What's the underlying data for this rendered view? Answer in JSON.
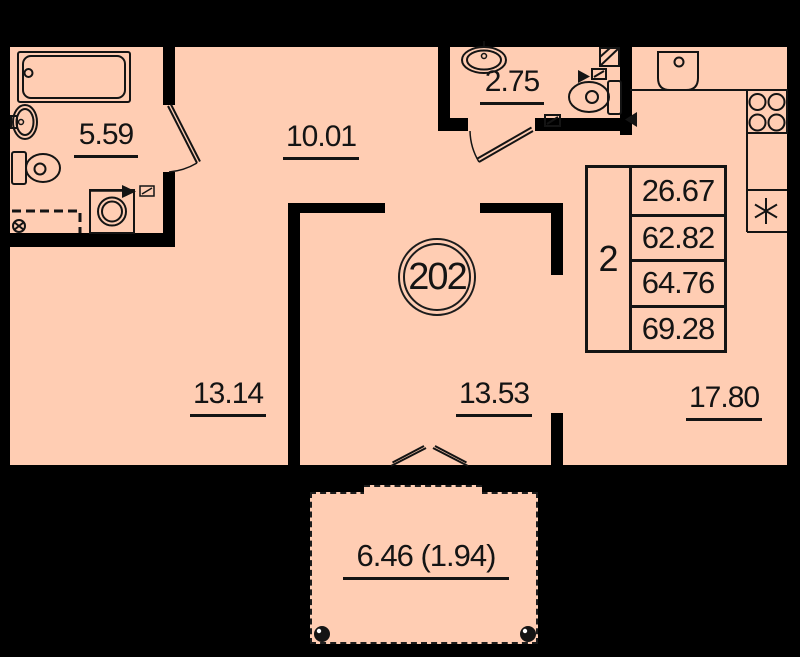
{
  "colors": {
    "floor": "#ffcdb3",
    "wall": "#000000",
    "ink": "#141414"
  },
  "apartment": {
    "number": "202"
  },
  "areas": {
    "bathroom": "5.59",
    "hallway": "10.01",
    "wc": "2.75",
    "room_left": "13.14",
    "room_center": "13.53",
    "kitchen_living": "17.80",
    "balcony": "6.46 (1.94)"
  },
  "info_table": {
    "rooms_count": "2",
    "values": [
      "26.67",
      "62.82",
      "64.76",
      "69.28"
    ]
  }
}
